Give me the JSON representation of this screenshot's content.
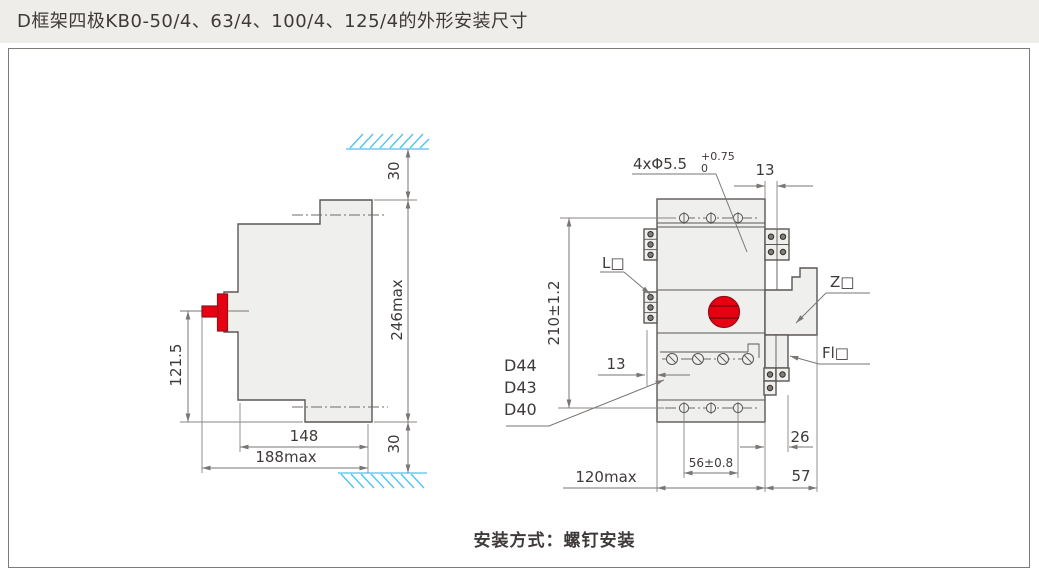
{
  "title": "D框架四极KB0-50/4、63/4、100/4、125/4的外形安装尺寸",
  "caption": "安装方式：螺钉安装",
  "colors": {
    "red_accent": "#e60012",
    "hatch_blue": "#4fc1ef",
    "body_fill": "#efefed",
    "line": "#5b5755",
    "title_bg": "#efedea",
    "text": "#3e3a39"
  },
  "side_view": {
    "dim_top_gap": "30",
    "dim_overall_height": "246max",
    "dim_bottom_gap": "30",
    "dim_handle_to_base": "121.5",
    "dim_body_depth": "148",
    "dim_overall_depth": "188max"
  },
  "front_view": {
    "dim_mounting_holes": "4xΦ5.5",
    "dim_hole_tol_upper": "+0.75",
    "dim_hole_tol_lower": "0",
    "dim_top_terminal_depth": "13",
    "dim_hole_pitch_vertical": "210±1.2",
    "dim_side_terminal_depth": "13",
    "dim_hole_pitch_horizontal": "56±0.8",
    "dim_lower_terminal_depth": "26",
    "dim_accessory_width": "57",
    "dim_overall_width": "120max",
    "label_aux_contact": "L□",
    "label_z_accessory": "Z□",
    "label_fl_accessory": "Fl□",
    "label_models": [
      "D44",
      "D43",
      "D40"
    ]
  }
}
